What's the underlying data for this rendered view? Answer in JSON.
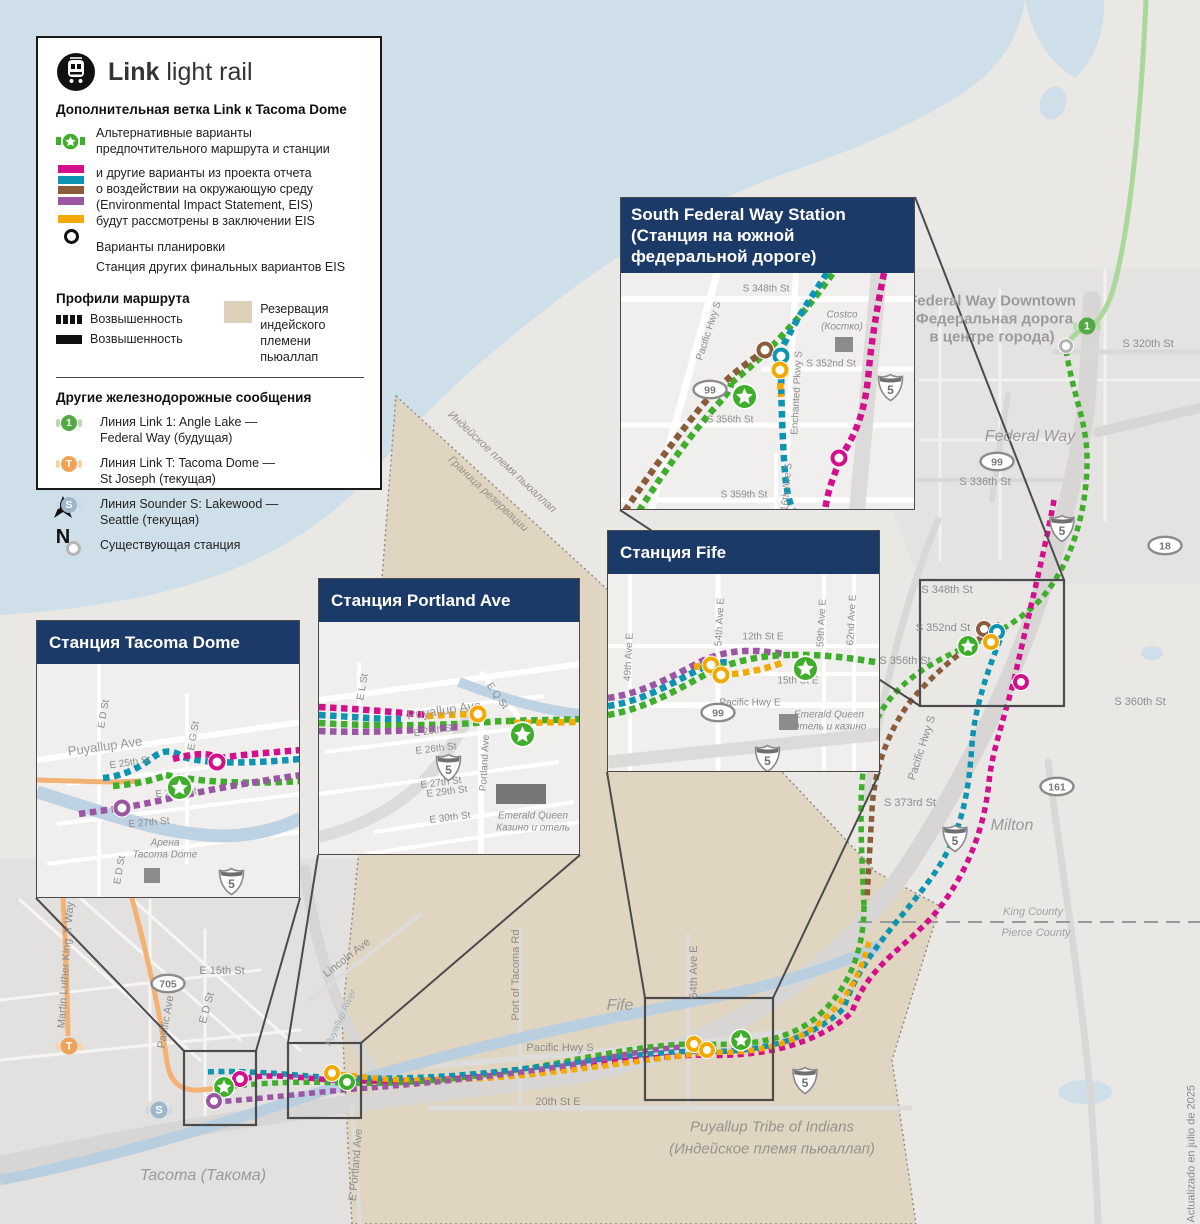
{
  "palette": {
    "navy": "#1b3a68",
    "green": "#3fae2a",
    "lightgreen": "#a9d79c",
    "magenta": "#d40f8c",
    "teal": "#0d94b2",
    "brown": "#8a5c3a",
    "purple": "#9a56a3",
    "yellow": "#f3a900",
    "orange": "#f3b273",
    "badge1": "#55a846",
    "badge1bar": "#b9ddb0",
    "badgeT": "#f0a259",
    "badgeTbar": "#f6d3a8",
    "badgeS": "#9fb6ca",
    "badgeSbar": "#cddae5",
    "tan": "#ddd0b8",
    "water": "#cfdfe9"
  },
  "legend": {
    "brand": {
      "bold": "Link",
      "rest": " light rail"
    },
    "subtitle": "Дополнительная ветка Link к Tacoma Dome",
    "preferred_lines": [
      "Альтернативные варианты",
      "предпочтительного маршрута и станции"
    ],
    "eis_lines": [
      "и другие варианты из проекта отчета",
      "о воздействии на окружающую среду",
      "(Environmental Impact Statement, EIS)",
      "будут рассмотрены в заключении EIS"
    ],
    "design_options": "Варианты планировки",
    "other_station": "Станция других финальных вариантов EIS",
    "profiles_title": "Профили маршрута",
    "profile_dashed": "Возвышенность",
    "profile_solid": "Возвышенность",
    "reservation_lines": [
      "Резервация",
      "индейского",
      "племени пьюаллап"
    ],
    "other_rail_title": "Другие железнодорожные сообщения",
    "rail_items": [
      {
        "badge": "1",
        "lines": [
          "Линия Link 1: Angle Lake —",
          "Federal Way (будущая)"
        ]
      },
      {
        "badge": "T",
        "lines": [
          "Линия Link T: Tacoma Dome —",
          "St Joseph (текущая)"
        ]
      },
      {
        "badge": "S",
        "lines": [
          "Линия Sounder S: Lakewood —",
          "Seattle (текущая)"
        ]
      }
    ],
    "existing_station": "Существующая станция"
  },
  "compass_label": "N",
  "credit": "Actualizado en julio de 2025",
  "map_labels": [
    {
      "t": "Federal Way Downtown",
      "x": 992,
      "y": 301,
      "cls": "fwd"
    },
    {
      "t": "(Федеральная дорога",
      "x": 992,
      "y": 319,
      "cls": "fwd"
    },
    {
      "t": "в центре города)",
      "x": 992,
      "y": 337,
      "cls": "fwd"
    },
    {
      "t": "S 320th St",
      "x": 1148,
      "y": 344,
      "cls": "st"
    },
    {
      "t": "Federal Way",
      "x": 1030,
      "y": 437,
      "cls": "city"
    },
    {
      "t": "S 336th St",
      "x": 985,
      "y": 482,
      "cls": "st"
    },
    {
      "t": "S 348th St",
      "x": 947,
      "y": 590,
      "cls": "st"
    },
    {
      "t": "S 352nd St",
      "x": 943,
      "y": 628,
      "cls": "st"
    },
    {
      "t": "S 356th St",
      "x": 905,
      "y": 661,
      "cls": "st"
    },
    {
      "t": "S 360th St",
      "x": 1140,
      "y": 702,
      "cls": "st"
    },
    {
      "t": "S 373rd St",
      "x": 910,
      "y": 803,
      "cls": "st"
    },
    {
      "t": "Pacific Hwy S",
      "x": 922,
      "y": 748,
      "rot": -72,
      "cls": "st"
    },
    {
      "t": "Milton",
      "x": 1012,
      "y": 826,
      "cls": "city"
    },
    {
      "t": "King County",
      "x": 1033,
      "y": 912,
      "cls": "county"
    },
    {
      "t": "Pierce County",
      "x": 1036,
      "y": 933,
      "cls": "county"
    },
    {
      "t": "Fife",
      "x": 620,
      "y": 1006,
      "cls": "city"
    },
    {
      "t": "54th Ave E",
      "x": 694,
      "y": 972,
      "rot": -90,
      "cls": "st"
    },
    {
      "t": "Port of Tacoma Rd",
      "x": 516,
      "y": 975,
      "rot": -90,
      "cls": "st"
    },
    {
      "t": "Pacific Hwy S",
      "x": 560,
      "y": 1048,
      "cls": "st"
    },
    {
      "t": "20th St E",
      "x": 558,
      "y": 1102,
      "cls": "st"
    },
    {
      "t": "Puyallup Tribe of Indians",
      "x": 772,
      "y": 1127,
      "cls": "tribe"
    },
    {
      "t": "(Индейское племя пьюаллап)",
      "x": 772,
      "y": 1149,
      "cls": "tribe"
    },
    {
      "t": "Tacoma (Такома)",
      "x": 203,
      "y": 1176,
      "cls": "city"
    },
    {
      "t": "Martin Luther King Jr Way",
      "x": 66,
      "y": 965,
      "rot": -86,
      "cls": "st"
    },
    {
      "t": "E 15th St",
      "x": 222,
      "y": 971,
      "cls": "st"
    },
    {
      "t": "E D St",
      "x": 207,
      "y": 1008,
      "rot": -75,
      "cls": "st"
    },
    {
      "t": "Pacific Ave",
      "x": 166,
      "y": 1022,
      "rot": -80,
      "cls": "st"
    },
    {
      "t": "Lincoln Ave",
      "x": 347,
      "y": 958,
      "rot": -38,
      "cls": "st"
    },
    {
      "t": "Puyallup River",
      "x": 341,
      "y": 1018,
      "rot": -65,
      "cls": "river"
    },
    {
      "t": "E Portland Ave",
      "x": 356,
      "y": 1165,
      "rot": -85,
      "cls": "st"
    },
    {
      "t": "Индейское племя пьюаллап",
      "x": 502,
      "y": 462,
      "rot": 43,
      "cls": "resv"
    },
    {
      "t": "Граница резервации",
      "x": 488,
      "y": 494,
      "rot": 43,
      "cls": "resv"
    }
  ],
  "map_shields": [
    {
      "kind": "i5",
      "text": "5",
      "x": 1062,
      "y": 531
    },
    {
      "kind": "i5",
      "text": "5",
      "x": 955,
      "y": 841
    },
    {
      "kind": "i5",
      "text": "5",
      "x": 805,
      "y": 1083
    },
    {
      "kind": "oval",
      "text": "99",
      "x": 997,
      "y": 464
    },
    {
      "kind": "oval",
      "text": "18",
      "x": 1165,
      "y": 548
    },
    {
      "kind": "oval",
      "text": "161",
      "x": 1057,
      "y": 789
    },
    {
      "kind": "oval",
      "text": "705",
      "x": 168,
      "y": 986
    }
  ],
  "badges": [
    {
      "text": "1",
      "color": "badge1",
      "bar": "badge1bar",
      "x": 1087,
      "y": 326
    },
    {
      "text": "T",
      "color": "badgeT",
      "bar": "badgeTbar",
      "x": 69,
      "y": 1046
    },
    {
      "text": "S",
      "color": "badgeS",
      "bar": "badgeSbar",
      "x": 159,
      "y": 1110
    }
  ],
  "stations": [
    {
      "k": "existing",
      "x": 1066,
      "y": 346,
      "scope": "main"
    },
    {
      "k": "star",
      "x": 968,
      "y": 646,
      "scope": "main"
    },
    {
      "k": "ring",
      "c": "brown",
      "x": 984,
      "y": 629,
      "scope": "main"
    },
    {
      "k": "ring",
      "c": "teal",
      "x": 997,
      "y": 632,
      "scope": "main"
    },
    {
      "k": "ring",
      "c": "yellow",
      "x": 991,
      "y": 642,
      "scope": "main"
    },
    {
      "k": "ring",
      "c": "magenta",
      "x": 1021,
      "y": 682,
      "scope": "main"
    },
    {
      "k": "star",
      "x": 741,
      "y": 1040,
      "scope": "main"
    },
    {
      "k": "ring",
      "c": "yellow",
      "x": 694,
      "y": 1044,
      "scope": "main"
    },
    {
      "k": "ring",
      "c": "yellow",
      "x": 707,
      "y": 1050,
      "scope": "main"
    },
    {
      "k": "ring",
      "c": "yellow",
      "x": 332,
      "y": 1073,
      "scope": "main"
    },
    {
      "k": "ring",
      "c": "green",
      "x": 347,
      "y": 1082,
      "scope": "main"
    },
    {
      "k": "ring",
      "c": "magenta",
      "x": 240,
      "y": 1079,
      "scope": "main"
    },
    {
      "k": "star",
      "x": 224,
      "y": 1087,
      "scope": "main"
    },
    {
      "k": "ring",
      "c": "purple",
      "x": 214,
      "y": 1101,
      "scope": "main"
    },
    {
      "k": "star",
      "x": 110,
      "y": 110,
      "scope": "sfw"
    },
    {
      "k": "ring",
      "c": "brown",
      "x": 144,
      "y": 77,
      "scope": "sfw"
    },
    {
      "k": "ring",
      "c": "teal",
      "x": 160,
      "y": 83,
      "scope": "sfw"
    },
    {
      "k": "ring",
      "c": "yellow",
      "x": 159,
      "y": 97,
      "scope": "sfw"
    },
    {
      "k": "ring",
      "c": "magenta",
      "x": 218,
      "y": 185,
      "scope": "sfw"
    },
    {
      "k": "star",
      "x": 184,
      "y": 81,
      "scope": "fife"
    },
    {
      "k": "ring",
      "c": "yellow",
      "x": 103,
      "y": 91,
      "scope": "fife"
    },
    {
      "k": "ring",
      "c": "yellow",
      "x": 113,
      "y": 101,
      "scope": "fife"
    },
    {
      "k": "star",
      "x": 190,
      "y": 99,
      "scope": "portland"
    },
    {
      "k": "ring",
      "c": "yellow",
      "x": 159,
      "y": 92,
      "scope": "portland"
    },
    {
      "k": "star",
      "x": 129,
      "y": 110,
      "scope": "tacoma"
    },
    {
      "k": "ring",
      "c": "magenta",
      "x": 180,
      "y": 98,
      "scope": "tacoma"
    },
    {
      "k": "ring",
      "c": "purple",
      "x": 85,
      "y": 144,
      "scope": "tacoma"
    }
  ],
  "insets": [
    {
      "id": "sfw",
      "title_lines": [
        "South Federal Way Station",
        "(Станция на южной",
        "федеральной дороге)"
      ],
      "labels": [
        {
          "t": "S 348th St",
          "x": 145,
          "y": 16,
          "cls": "ist"
        },
        {
          "t": "Pacific Hwy S",
          "x": 88,
          "y": 58,
          "rot": -72,
          "cls": "ist"
        },
        {
          "t": "Costco",
          "x": 221,
          "y": 42,
          "cls": "ist-it"
        },
        {
          "t": "(Костко)",
          "x": 221,
          "y": 54,
          "cls": "ist-it"
        },
        {
          "t": "S 352nd St",
          "x": 210,
          "y": 91,
          "cls": "ist"
        },
        {
          "t": "Enchanted Pkwy S",
          "x": 176,
          "y": 120,
          "rot": -87,
          "cls": "ist"
        },
        {
          "t": "S 356th St",
          "x": 109,
          "y": 147,
          "cls": "ist"
        },
        {
          "t": "16th Ave S",
          "x": 166,
          "y": 214,
          "rot": -85,
          "cls": "ist"
        },
        {
          "t": "S 359th St",
          "x": 123,
          "y": 222,
          "cls": "ist"
        }
      ],
      "shields": [
        {
          "kind": "oval",
          "text": "99",
          "x": 70,
          "y": 106
        },
        {
          "kind": "i5",
          "text": "5",
          "x": 256,
          "y": 100
        }
      ]
    },
    {
      "id": "fife",
      "title_lines": [
        "Станция Fife"
      ],
      "labels": [
        {
          "t": "49th Ave E",
          "x": 21,
          "y": 83,
          "rot": -87,
          "cls": "ist"
        },
        {
          "t": "54th Ave E",
          "x": 112,
          "y": 48,
          "rot": -87,
          "cls": "ist"
        },
        {
          "t": "12th St E",
          "x": 155,
          "y": 63,
          "cls": "ist"
        },
        {
          "t": "59th Ave E",
          "x": 214,
          "y": 49,
          "rot": -87,
          "cls": "ist"
        },
        {
          "t": "62nd Ave E",
          "x": 244,
          "y": 46,
          "rot": -87,
          "cls": "ist"
        },
        {
          "t": "15th St E",
          "x": 190,
          "y": 107,
          "cls": "ist"
        },
        {
          "t": "Pacific Hwy E",
          "x": 142,
          "y": 129,
          "cls": "ist"
        },
        {
          "t": "Emerald Queen",
          "x": 221,
          "y": 141,
          "cls": "ist-it"
        },
        {
          "t": "Отель и казино",
          "x": 221,
          "y": 153,
          "cls": "ist-it"
        }
      ],
      "shields": [
        {
          "kind": "oval",
          "text": "99",
          "x": 91,
          "y": 128
        },
        {
          "kind": "i5",
          "text": "5",
          "x": 146,
          "y": 170
        }
      ]
    },
    {
      "id": "portland",
      "title_lines": [
        "Станция Portland Ave"
      ],
      "labels": [
        {
          "t": "Puyallup Ave",
          "x": 125,
          "y": 88,
          "rot": -8,
          "cls": "ist-big"
        },
        {
          "t": "E 25th St",
          "x": 115,
          "y": 109,
          "rot": -8,
          "cls": "ist"
        },
        {
          "t": "E 26th St",
          "x": 117,
          "y": 127,
          "rot": -7,
          "cls": "ist"
        },
        {
          "t": "E Q St",
          "x": 178,
          "y": 74,
          "rot": 55,
          "cls": "ist"
        },
        {
          "t": "E L St",
          "x": 44,
          "y": 65,
          "rot": -80,
          "cls": "ist"
        },
        {
          "t": "E 27th St",
          "x": 122,
          "y": 161,
          "rot": -7,
          "cls": "ist"
        },
        {
          "t": "E 29th St",
          "x": 128,
          "y": 170,
          "rot": -7,
          "cls": "ist"
        },
        {
          "t": "E 30th St",
          "x": 131,
          "y": 196,
          "rot": -7,
          "cls": "ist"
        },
        {
          "t": "Portland Ave",
          "x": 166,
          "y": 141,
          "rot": -87,
          "cls": "ist"
        },
        {
          "t": "Emerald Queen",
          "x": 214,
          "y": 194,
          "cls": "ist-it"
        },
        {
          "t": "Казино и отель",
          "x": 214,
          "y": 206,
          "cls": "ist-it"
        }
      ],
      "shields": [
        {
          "kind": "i5",
          "text": "5",
          "x": 116,
          "y": 131
        }
      ]
    },
    {
      "id": "tacoma",
      "title_lines": [
        "Станция Tacoma Dome"
      ],
      "labels": [
        {
          "t": "E D St",
          "x": 67,
          "y": 50,
          "rot": -80,
          "cls": "ist"
        },
        {
          "t": "Puyallup Ave",
          "x": 68,
          "y": 82,
          "rot": -8,
          "cls": "ist-big"
        },
        {
          "t": "E 25th St",
          "x": 93,
          "y": 99,
          "rot": -8,
          "cls": "ist"
        },
        {
          "t": "E G St",
          "x": 157,
          "y": 72,
          "rot": -80,
          "cls": "ist"
        },
        {
          "t": "E 26th St",
          "x": 139,
          "y": 129,
          "rot": -5,
          "cls": "ist"
        },
        {
          "t": "E 27th St",
          "x": 112,
          "y": 159,
          "rot": -5,
          "cls": "ist"
        },
        {
          "t": "Арена",
          "x": 128,
          "y": 179,
          "cls": "ist-it"
        },
        {
          "t": "Tacoma Dome",
          "x": 128,
          "y": 191,
          "cls": "ist-it"
        },
        {
          "t": "E D St",
          "x": 83,
          "y": 206,
          "rot": -80,
          "cls": "ist"
        }
      ],
      "shields": [
        {
          "kind": "i5",
          "text": "5",
          "x": 181,
          "y": 203
        }
      ]
    }
  ]
}
